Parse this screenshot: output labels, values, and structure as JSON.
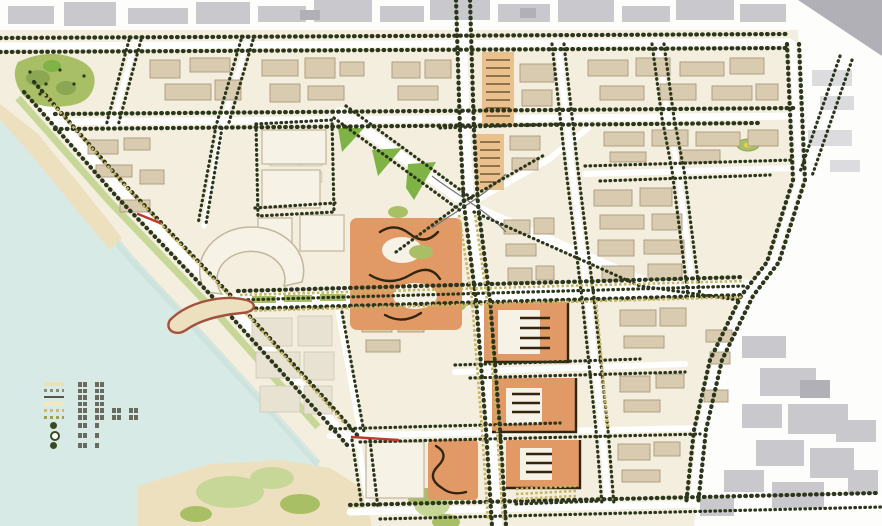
{
  "colors": {
    "paper": "#fdfdfb",
    "base": "#f3eedd",
    "water": "#d6eae5",
    "water_edge": "#c4ded8",
    "sand": "#eee0bd",
    "road": "#ffffff",
    "tree": "#2b361b",
    "hedge": "#c9b45f",
    "park": "#a9bf63",
    "park_bright": "#7fb441",
    "park_light": "#c6d795",
    "park_dark": "#8aa84e",
    "building": "#d9cbae",
    "building_stroke": "#ab9a7c",
    "faint_building": "#e8e2d2",
    "faint_building_stroke": "#cfc6b2",
    "white_building": "#f6f2e6",
    "white_building_stroke": "#c2b69a",
    "orange": "#e39963",
    "orange_light": "#ecc08b",
    "orange_stroke": "#33250f",
    "context": "#c9c9cd",
    "context_dark": "#b0b0b6",
    "context_light": "#dcdcdf",
    "red": "#c0392b",
    "pier_stroke": "#a5503a",
    "ramp": "#7a7a78",
    "marker_yellow": "#e8d44e"
  },
  "legend": {
    "items": [
      {
        "name": "item-1",
        "symbol": "band",
        "color": "#e9e2b8",
        "text_blocks": [
          2,
          2
        ]
      },
      {
        "name": "item-2",
        "symbol": "dashes",
        "color": "#8a8a7a",
        "text_blocks": [
          2,
          2
        ]
      },
      {
        "name": "item-3",
        "symbol": "line",
        "color": "#555548",
        "text_blocks": [
          2,
          2
        ]
      },
      {
        "name": "item-4",
        "symbol": "band",
        "color": "#efe8c0",
        "text_blocks": [
          2,
          2
        ]
      },
      {
        "name": "item-5",
        "symbol": "hedge",
        "color": "#cdbb6a",
        "text_blocks": [
          2,
          2,
          2,
          2
        ]
      },
      {
        "name": "item-6",
        "symbol": "hedge",
        "color": "#9aa050",
        "text_blocks": [
          2,
          2,
          2,
          2
        ]
      },
      {
        "name": "item-7",
        "symbol": "tree",
        "color": "#3a4a22",
        "text_blocks": [
          2,
          1
        ]
      },
      {
        "name": "item-8",
        "symbol": "tree-ring",
        "color": "#3a4a22",
        "text_blocks": [
          2,
          1
        ]
      },
      {
        "name": "item-9",
        "symbol": "tree",
        "color": "#3a4a22",
        "text_blocks": [
          2,
          1
        ]
      }
    ]
  }
}
